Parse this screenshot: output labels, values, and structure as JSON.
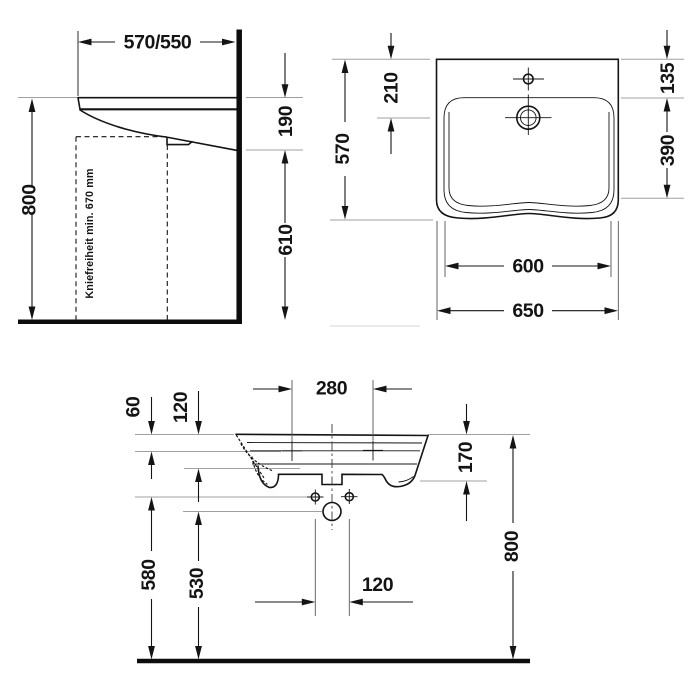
{
  "title": "Washbasin dimensional drawing",
  "unit": "mm",
  "colors": {
    "line": "#141414",
    "extension": "#a0a0a0",
    "background": "#ffffff"
  },
  "side_view": {
    "width": "570/550",
    "height_to_rim": "800",
    "rim_to_underside": "190",
    "underside_clearance": "610",
    "knee_clearance_note": "Kniefreiheit min. 670 mm"
  },
  "top_view": {
    "depth": "570",
    "front_edge_to_drain": "210",
    "rear_edge_to_bowl": "135",
    "bowl_depth": "390",
    "bowl_width": "600",
    "overall_width": "650"
  },
  "front_view": {
    "tap_hole_spacing": "280",
    "rim_to_tap_holes": "60",
    "rim_to_inner_edge": "120",
    "apron_height": "170",
    "rim_height": "800",
    "fixing_hole_height": "580",
    "drain_height": "530",
    "fixing_hole_spacing": "120"
  }
}
